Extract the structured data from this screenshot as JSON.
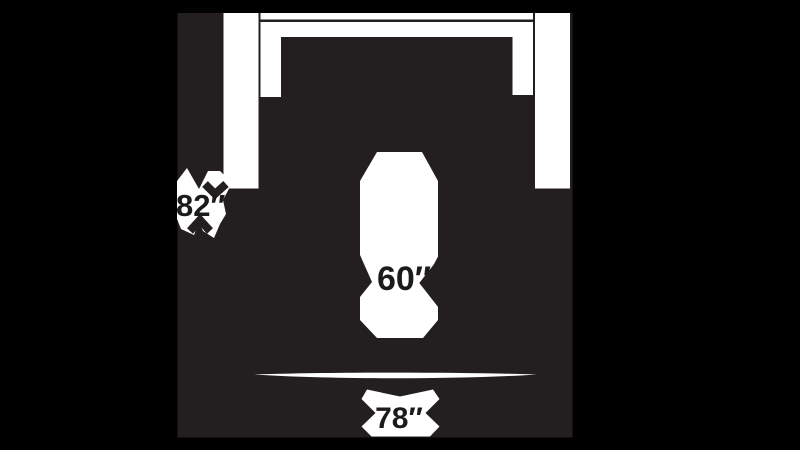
{
  "figure": {
    "kind": "sofa-top-view-dimension-diagram",
    "colors": {
      "background": "#000000",
      "panel": "#231f20",
      "artwork": "#ffffff",
      "label_text": "#1d1a1b"
    }
  },
  "dimensions": {
    "depth": {
      "label": "82″",
      "value": 82,
      "unit": "in"
    },
    "seat_width": {
      "label": "60″",
      "value": 60,
      "unit": "in"
    },
    "overall_width": {
      "label": "78″",
      "value": 78,
      "unit": "in"
    }
  }
}
